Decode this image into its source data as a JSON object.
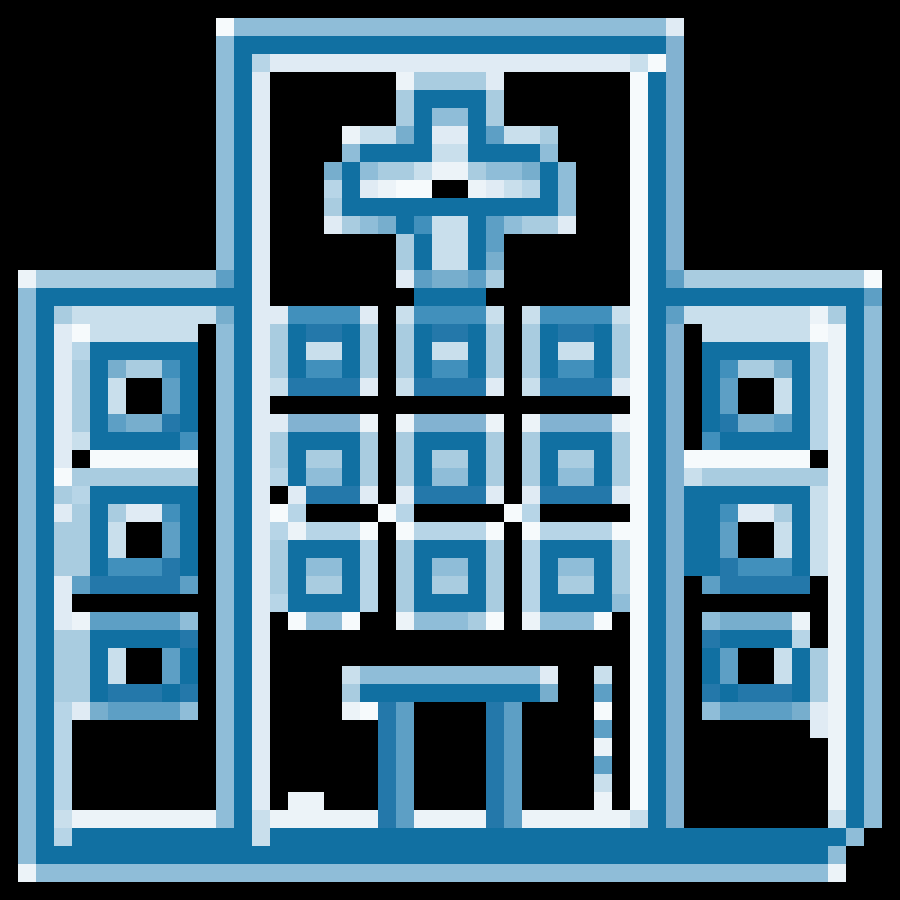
{
  "image": {
    "title": "Pixel art hospital building icon",
    "description": "Blue pixel-art hospital: roof bar, medical cross, three rows of windows, side wings with stacked windows, entrance awning with posts",
    "grid": {
      "cols": 50,
      "rows": 50,
      "cell_px": 18
    },
    "background": "#000000",
    "palette": {
      ".": "#000000",
      "D": "#1170a2",
      "d": "#2478aa",
      "m": "#4190bc",
      "M": "#5d9fc5",
      "o": "#77aecd",
      "B": "#82b2d1",
      "L": "#8fbdd8",
      "A": "#a9cce0",
      "P": "#b7d5e7",
      "C": "#c9dfec",
      "E": "#e0ebf4",
      "W": "#ecf3f8",
      "w": "#f6fafc"
    },
    "rows": [
      "..................................................",
      "............wLLLLLLLLLLLLLLLLLLLLLLLLE............",
      "............LDDDDDDDDDDDDDDDDDDDDDDDDB............",
      "............LDPEEEEEEEEEEEEEEEEEEEECwB............",
      "............LDE.......WAAAAE.......wDB............",
      "............LDE.......ADDDDA.......wDB............",
      "............LDE.......ADLLDA.......wDB............",
      "............LDE....WCCoDEEDMCCA....wDB............",
      "............LDE....LDDDDCCDDDDL....wDB............",
      "............LDE...oDLAACWWALLoDL...wDB............",
      "............LDE...PDEWww..WECPDL...wDB............",
      "............LDE...ADDDDDDDDDDDDL...wDB............",
      "............LDE...EALoDmCCDMLAAE...wDB............",
      "............LDE.......ADCCDM.......wDB............",
      "............LDE.......ADCCDo.......wDB............",
      ".WAAAAAAAAAAMDE.......EMooMA.......wDMAAAAAAAAAAw.",
      ".LDDDDDDDDDDDDE........DDDD........wDDDDDDDDDDDDM.",
      ".LDACCCCCCCCoDEEmmmmE.CmmmmC.CmmmmCwDMCCCCCCCWADL.",
      ".LDEwCCCCCC.LDEADddDA.ADddDA.ADddDAwDB.CCCCCCwWDL.",
      ".LDEPDDDDDD.LDEADCCDA.ADCCDA.ADCCDAwDB.DDDDDDPWDL.",
      ".LDEADoAAmD.LDEADmmDA.ADmmDA.ADmmDAwDB.DmAAoDPWDL.",
      ".LDEADC..MD.LDECddddE.CddddE.CddddEwDB.DM..CDPWDL.",
      ".LDEADC..MD.LDE....................wDB.DM..CDPWDL.",
      ".LDEADMoodD.LDEEBBBBW.WBBBBW.WBBBBWwDB.DdooMDPWDL.",
      ".LDECDDDDDm.LDEADDDDA.ADDDDA.ADDDDAwDB.mDDDDDPWDL.",
      ".LDE.wwwwww.LDEADAADA.ADAADA.ADAADAwDBwwwwwww.WDL.",
      ".LDwAAAAAAA.LDEPDLLDA.ADLLDA.ADLLDAwDBCAAAAAAAWDL.",
      ".LDAPDDDDDD.LDE.EdddE.EddddE.EddddEwDBDDDDDDDCWDL.",
      ".LDEADAEEmD.LDEwP....wP.....wP.....wDBDDmEEADCWDL.",
      ".LDAADC..MD.LDEPWPPPw.wPPPPw.wPPPPwwDBDDM..CDCWDL.",
      ".LDAADC..MD.LDEADDDDP.ADDDDA.PDDDDAwDBDDM..CDCWDL.",
      ".LDAADmmmdD.LDEADLLDP.ADLLDA.PDLLDAwDBDDdmmmDCWDL.",
      ".LDEMdddddM.LDEADAADP.ADAADA.PDAADAwDB.Mddddd.WDL.",
      ".LDE........LDEPDDDDP.ADDDDA.PDDDDLwDB........WDL.",
      ".LDEWMMMMML.LDE.wLLw..WLLLAw.WLLLw.wDB.LooooW.WDL.",
      ".LDAADDDDDd.LDE....................wDB.dDDDDP.WDL.",
      ".LDAADC..MD.LDE....................wDB.DM..CDAWDL.",
      ".LDAADC..MD.LDE....CLLLLLLLLLLE..C.wDB.DM..CDAWDL.",
      ".LDAADdddDd.LDE....ADDDDDDDDDDo..M.wDB.dDdddDAWDL.",
      ".LDPEoMMMML.LDE....WwdM....dM....w.wDB.LMMMMoEWDL.",
      ".LDP........LDE......dM....dM....M.wDB.......EWDL.",
      ".LDP........LDE......dM....dM....W.wDB........WDL.",
      ".LDP........LDE......dM....dM....M.wDB........WDL.",
      ".LDP........LDE......dM....dM....C.wDB........WDL.",
      ".LDP........LDE.WW...dM....dM....W.wDB........WDL.",
      ".LDCWWWWWWWWLDCWWWWWWdMWWWWdMWWWWWWCDB........CDL.",
      ".LDPDDDDDDDDDDCDDDDDDDDDDDDDDDDDDDDDDDDDDDDDDDDL.",
      ".LDDDDDDDDDDDDDDDDDDDDDDDDDDDDDDDDDDDDDDDDDDDDL.",
      ".WLLLLLLLLLLLLLLLLLLLLLLLLLLLLLLLLLLLLLLLLLLLLW.",
      ".................................................."
    ]
  }
}
